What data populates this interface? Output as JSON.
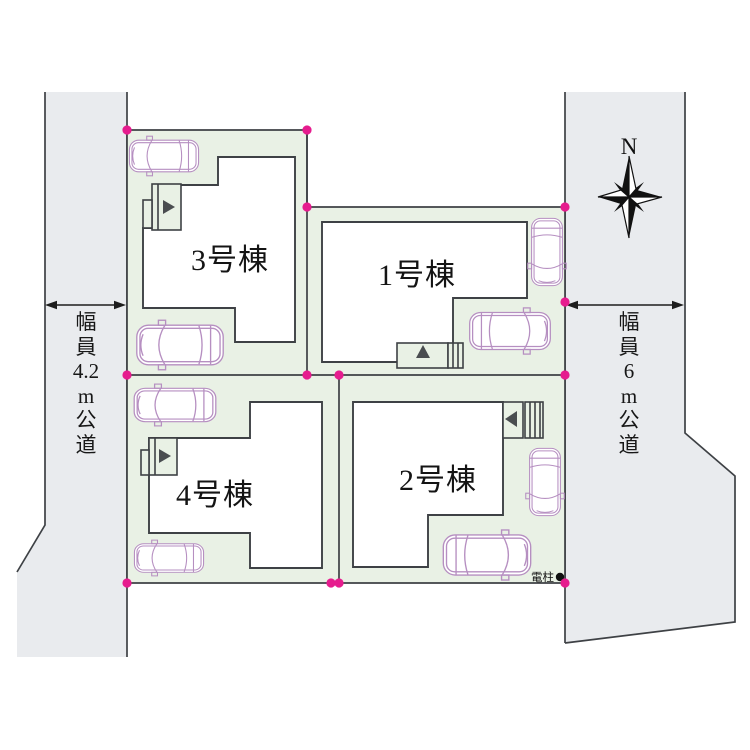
{
  "plan": {
    "buildings": [
      {
        "label": "1号棟"
      },
      {
        "label": "2号棟"
      },
      {
        "label": "3号棟"
      },
      {
        "label": "4号棟"
      }
    ],
    "roads": {
      "left": {
        "label": "幅員4.2m公道",
        "lines": [
          "幅",
          "員",
          "4.2",
          "m",
          "公",
          "道"
        ]
      },
      "right": {
        "label": "幅員6m公道",
        "lines": [
          "幅",
          "員",
          "6",
          "m",
          "公",
          "道"
        ]
      }
    },
    "compass": {
      "label": "N"
    },
    "utility_pole": {
      "label": "電柱"
    },
    "colors": {
      "road_fill": "#e9ebee",
      "lot_fill": "#e9f1e5",
      "line": "#3e4145",
      "corner_dot": "#e61c8e",
      "car_outline": "#b68fc1",
      "building_fill": "#ffffff"
    }
  }
}
